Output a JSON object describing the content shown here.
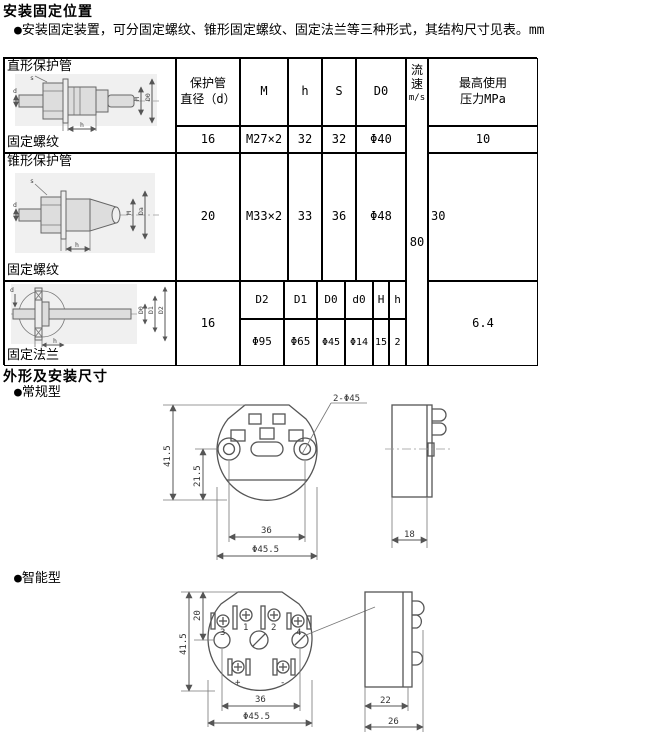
{
  "page": {
    "title": "安装固定位置",
    "intro": "●安装固定装置，可分固定螺纹、锥形固定螺纹、固定法兰等三种形式，其结构尺寸见表。mm",
    "outline_title": "外形及安装尺寸",
    "regular_label": "●常规型",
    "smart_label": "●智能型"
  },
  "table": {
    "col_headers": {
      "diameter_line1": "保护管",
      "diameter_line2": "直径（d）",
      "m": "M",
      "h": "h",
      "s": "S",
      "d0": "D0",
      "flow_speed": "流速",
      "flow_unit": "m/s",
      "pressure_line1": "最高使用",
      "pressure_line2": "压力MPa"
    },
    "flow_value": "80",
    "row1": {
      "type": "直形保护管",
      "fixing": "固定螺纹",
      "diameter": "16",
      "m": "M27×2",
      "h": "32",
      "s": "32",
      "d0": "Φ40",
      "pressure": "10"
    },
    "row2": {
      "type": "锥形保护管",
      "fixing": "固定螺纹",
      "diameter": "20",
      "m": "M33×2",
      "h": "33",
      "s": "36",
      "d0": "Φ48",
      "pressure": "30"
    },
    "row3": {
      "fixing": "固定法兰",
      "diameter": "16",
      "pressure": "6.4",
      "sub_headers": [
        "D2",
        "D1",
        "D0",
        "d0",
        "H",
        "h"
      ],
      "sub_values": [
        "Φ95",
        "Φ65",
        "Φ45",
        "Φ14",
        "15",
        "2"
      ]
    }
  },
  "drawings": {
    "straight": {
      "labels": {
        "s": "s",
        "d": "d",
        "m": "M",
        "d0": "D0",
        "h": "h"
      }
    },
    "conical": {
      "labels": {
        "s": "s",
        "d": "d",
        "m": "M",
        "d0": "Da",
        "h": "h"
      }
    },
    "flange": {
      "labels": {
        "d": "d",
        "d0": "D0",
        "d1": "D1",
        "d2": "D2",
        "h": "h"
      }
    },
    "regular_front": {
      "height": "41.5",
      "half_height": "21.5",
      "hole_note": "2-Φ45",
      "hole_span": "36",
      "diameter": "Φ45.5"
    },
    "regular_side": {
      "depth": "18"
    },
    "smart_front": {
      "height": "41.5",
      "top_height": "20",
      "hole_span": "36",
      "diameter": "Φ45.5",
      "terminals": {
        "t3": "3",
        "t1": "1",
        "t2": "2",
        "t4": "4",
        "plus": "+",
        "minus": "-"
      }
    },
    "smart_side": {
      "depth_inner": "22",
      "depth_outer": "26"
    }
  }
}
